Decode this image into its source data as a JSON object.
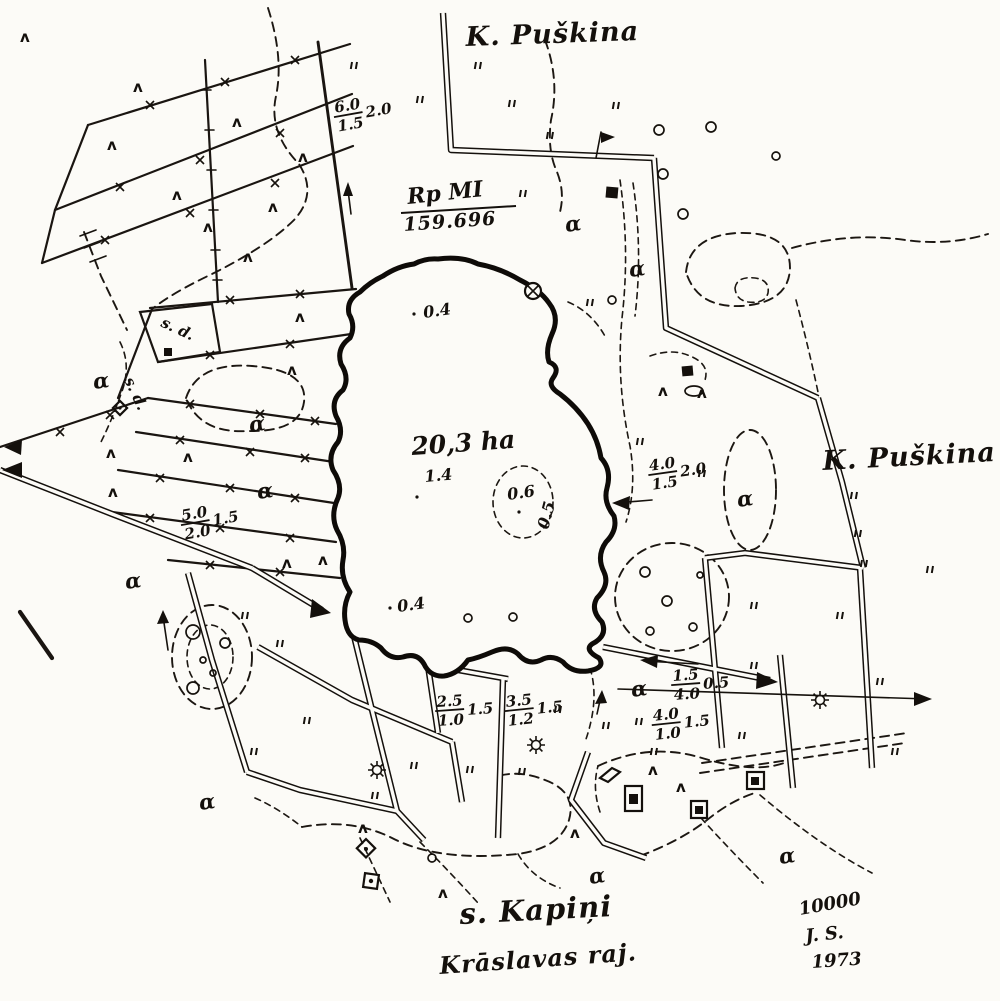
{
  "map": {
    "labels": {
      "village_top": "K. Puškina",
      "village_right": "K. Puškina",
      "village_bottom": "s. Kapiņi",
      "district": "Krāslavas raj.",
      "benchmark_name": "Rp MI",
      "benchmark_elevation": "159.696",
      "scale": "10000",
      "surveyor_initials": "J. S.",
      "survey_year": "1973",
      "parcel_sd_1": "s. d.",
      "parcel_sd_2": "s. d."
    },
    "lake": {
      "area_label": "20,3 ha",
      "depth_top": "0.4",
      "depth_center": "1.4",
      "depth_shoal": "0.6",
      "depth_shoal_edge": "0.5",
      "depth_bottom": "0.4"
    },
    "road_specs": [
      {
        "num": "6.0",
        "den": "1.5",
        "side": "2.0"
      },
      {
        "num": "4.0",
        "den": "1.5",
        "side": "2.0"
      },
      {
        "num": "5.0",
        "den": "2.0",
        "side": "1.5"
      },
      {
        "num": "2.5",
        "den": "1.0",
        "side": "1.5"
      },
      {
        "num": "3.5",
        "den": "1.2",
        "side": "1.5"
      },
      {
        "num": "1.5",
        "den": "4.0",
        "side": "0.5"
      },
      {
        "num": "4.0",
        "den": "1.0",
        "side": "1.5"
      }
    ],
    "symbols": {
      "alpha": "α",
      "tree": "ʌ"
    },
    "points": {
      "alpha": [
        [
          566,
          232
        ],
        [
          630,
          277
        ],
        [
          94,
          389
        ],
        [
          250,
          432
        ],
        [
          258,
          499
        ],
        [
          738,
          507
        ],
        [
          126,
          589
        ],
        [
          200,
          810
        ],
        [
          590,
          884
        ],
        [
          780,
          864
        ],
        [
          632,
          697
        ]
      ],
      "tree": [
        [
          20,
          42
        ],
        [
          133,
          92
        ],
        [
          107,
          150
        ],
        [
          172,
          200
        ],
        [
          232,
          127
        ],
        [
          268,
          212
        ],
        [
          298,
          162
        ],
        [
          243,
          262
        ],
        [
          203,
          232
        ],
        [
          295,
          322
        ],
        [
          287,
          375
        ],
        [
          106,
          458
        ],
        [
          183,
          462
        ],
        [
          318,
          565
        ],
        [
          282,
          568
        ],
        [
          658,
          396
        ],
        [
          697,
          398
        ],
        [
          648,
          775
        ],
        [
          676,
          792
        ],
        [
          358,
          833
        ],
        [
          438,
          898
        ],
        [
          570,
          838
        ],
        [
          108,
          497
        ]
      ],
      "grass": [
        [
          352,
          62
        ],
        [
          418,
          96
        ],
        [
          510,
          100
        ],
        [
          614,
          102
        ],
        [
          548,
          132
        ],
        [
          588,
          299
        ],
        [
          638,
          438
        ],
        [
          700,
          470
        ],
        [
          852,
          492
        ],
        [
          856,
          530
        ],
        [
          752,
          602
        ],
        [
          838,
          612
        ],
        [
          752,
          662
        ],
        [
          878,
          678
        ],
        [
          637,
          718
        ],
        [
          740,
          732
        ],
        [
          893,
          748
        ],
        [
          243,
          612
        ],
        [
          278,
          640
        ],
        [
          305,
          717
        ],
        [
          252,
          748
        ],
        [
          373,
          792
        ],
        [
          412,
          762
        ],
        [
          468,
          766
        ],
        [
          520,
          768
        ],
        [
          556,
          706
        ],
        [
          604,
          722
        ],
        [
          652,
          748
        ],
        [
          862,
          560
        ],
        [
          928,
          566
        ],
        [
          521,
          190
        ],
        [
          476,
          62
        ]
      ],
      "xmark": [
        [
          150,
          105
        ],
        [
          225,
          82
        ],
        [
          295,
          60
        ],
        [
          120,
          187
        ],
        [
          200,
          160
        ],
        [
          280,
          133
        ],
        [
          105,
          240
        ],
        [
          190,
          213
        ],
        [
          275,
          183
        ],
        [
          230,
          300
        ],
        [
          300,
          294
        ],
        [
          210,
          355
        ],
        [
          290,
          344
        ],
        [
          190,
          404
        ],
        [
          260,
          414
        ],
        [
          315,
          421
        ],
        [
          180,
          440
        ],
        [
          250,
          452
        ],
        [
          305,
          458
        ],
        [
          160,
          478
        ],
        [
          230,
          488
        ],
        [
          295,
          498
        ],
        [
          150,
          518
        ],
        [
          220,
          528
        ],
        [
          290,
          538
        ],
        [
          210,
          565
        ],
        [
          280,
          572
        ],
        [
          60,
          432
        ],
        [
          110,
          415
        ]
      ],
      "circle": [
        [
          659,
          130,
          5
        ],
        [
          711,
          127,
          5
        ],
        [
          776,
          156,
          4
        ],
        [
          663,
          174,
          5
        ],
        [
          683,
          214,
          5
        ],
        [
          612,
          300,
          4
        ],
        [
          645,
          572,
          5
        ],
        [
          667,
          601,
          5
        ],
        [
          650,
          631,
          4
        ],
        [
          693,
          627,
          4
        ],
        [
          468,
          618,
          4
        ],
        [
          513,
          617,
          4
        ],
        [
          193,
          632,
          7
        ],
        [
          225,
          643,
          5
        ],
        [
          203,
          660,
          3
        ],
        [
          213,
          673,
          3
        ],
        [
          193,
          688,
          6
        ],
        [
          432,
          858,
          4
        ],
        [
          700,
          575,
          3
        ]
      ],
      "sun": [
        [
          536,
          745
        ],
        [
          377,
          770
        ],
        [
          820,
          700
        ]
      ]
    }
  }
}
